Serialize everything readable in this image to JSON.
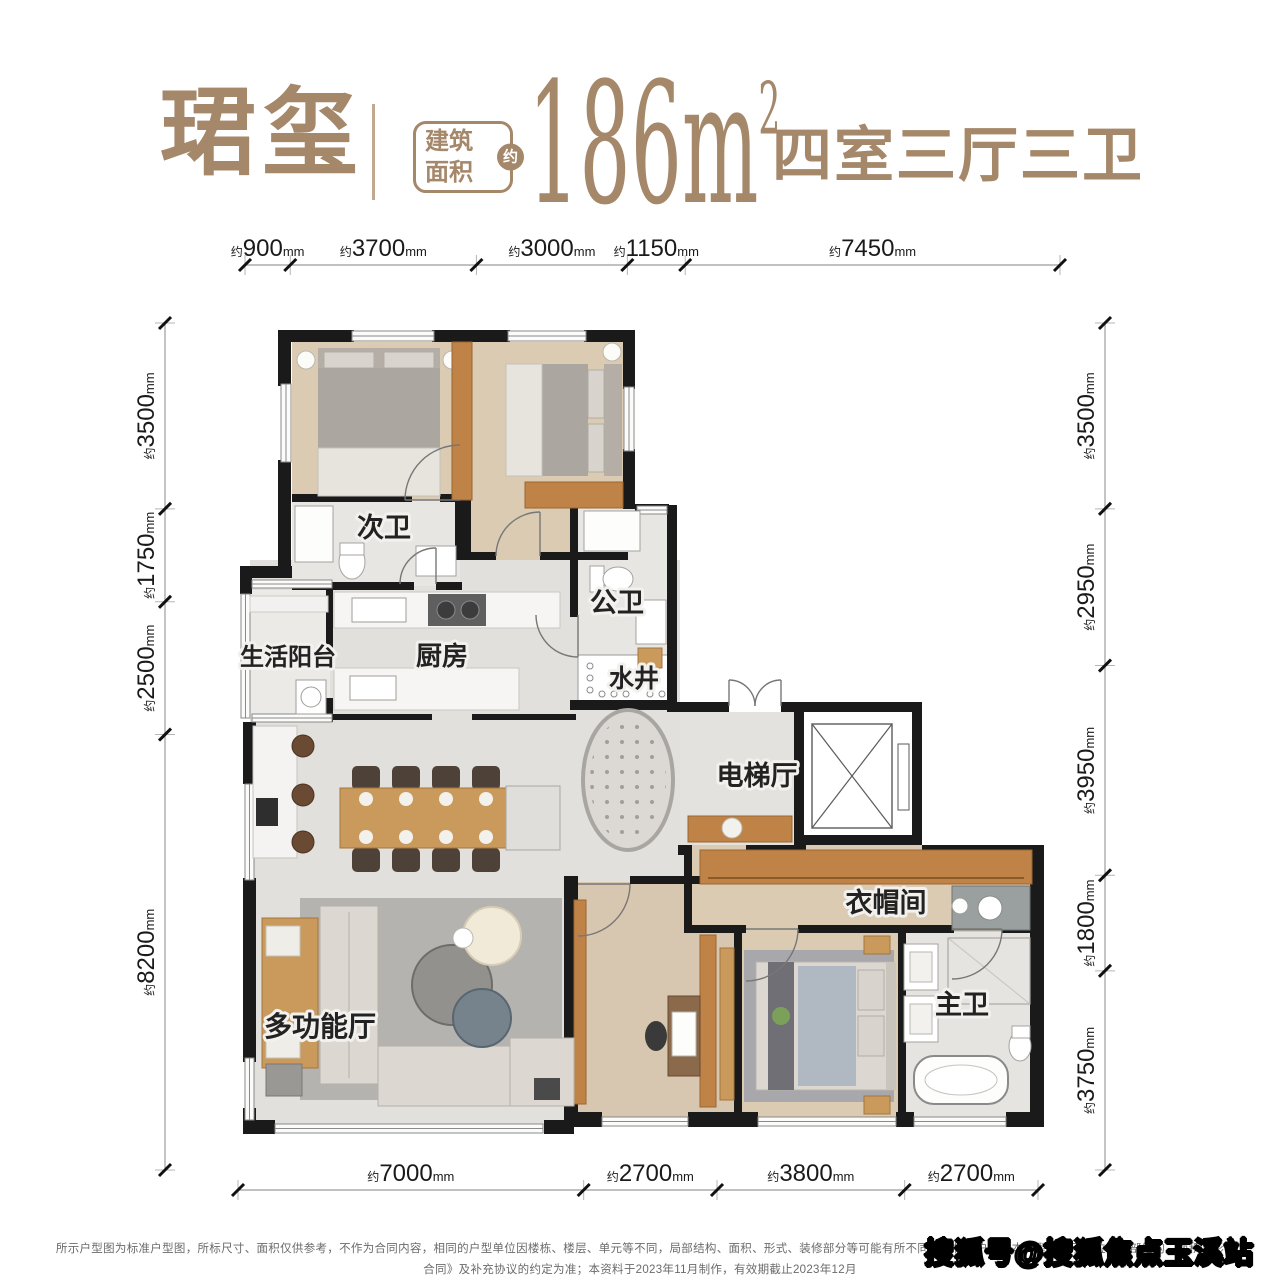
{
  "header": {
    "title": "珺玺",
    "area_badge_line1": "建筑",
    "area_badge_line2": "面积",
    "area_badge_approx": "约",
    "area_value": "186",
    "area_unit": "m",
    "area_exponent": "2",
    "layout_summary": "四室三厅三卫"
  },
  "dimensions": {
    "prefix": "约",
    "unit": "mm",
    "top": [
      "900",
      "3700",
      "3000",
      "1150",
      "7450"
    ],
    "left": [
      "3500",
      "1750",
      "2500",
      "8200"
    ],
    "right": [
      "3500",
      "2950",
      "3950",
      "1800",
      "3750"
    ],
    "bottom": [
      "7000",
      "2700",
      "3800",
      "2700"
    ]
  },
  "rooms": {
    "secondary_bath": "次卫",
    "public_bath": "公卫",
    "water_well": "水井",
    "service_balcony": "生活阳台",
    "kitchen": "厨房",
    "elevator_hall": "电梯厅",
    "cloakroom": "衣帽间",
    "multifunction_hall": "多功能厅",
    "master_bath": "主卫"
  },
  "footer": {
    "disclaimer_line1": "所示户型图为标准户型图，所标尺寸、面积仅供参考，不作为合同内容，相同的户型单位因楼栋、楼层、单元等不同，局部结构、面积、形式、装修部分等可能有所不同，非标准户型与本户型图所示单位的局部结构、面积、形",
    "disclaimer_line2": "合同》及补充协议的约定为准；本资料于2023年11月制作，有效期截止2023年12月"
  },
  "watermark": "搜狐号@搜狐焦点玉溪站",
  "colors": {
    "accent": "#a5876a",
    "wall": "#1a1a1a",
    "wood_floor": "#dccbb3",
    "marble_floor": "#e2e0dd",
    "tile_floor": "#e6e4e1",
    "furniture_wood": "#c08347",
    "dimension_text": "#1a1a1a"
  }
}
